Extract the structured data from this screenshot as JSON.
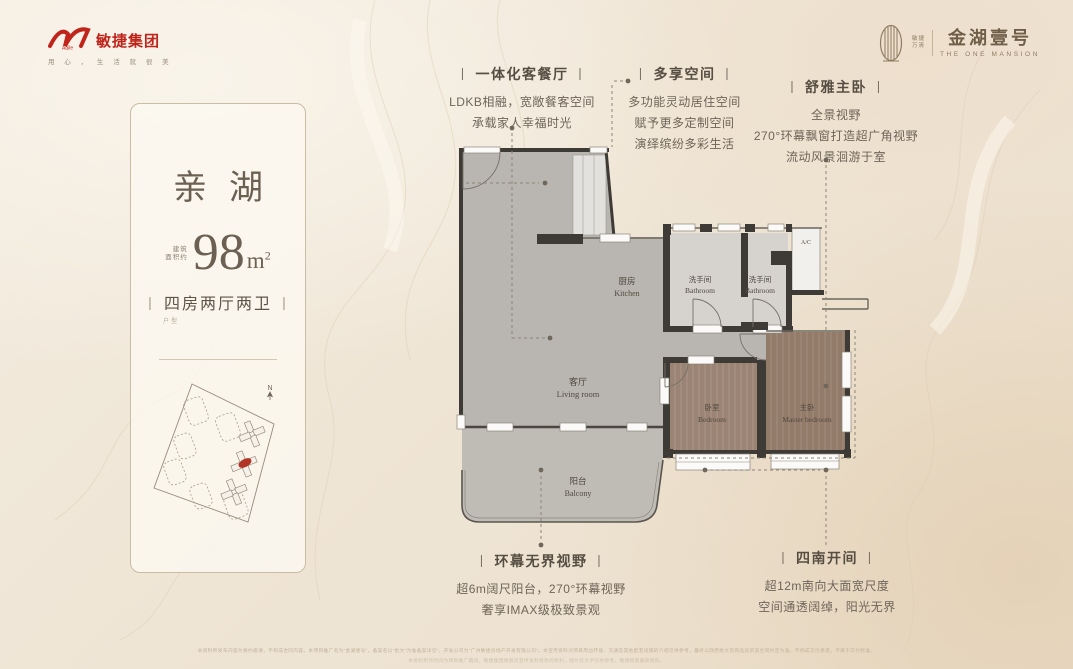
{
  "ui": {
    "bar": "丨"
  },
  "brand_left": {
    "logo_text": "敏捷集团",
    "logo_sub": "Agile",
    "tagline": "用 心 ， 生 活 就 很 美"
  },
  "brand_right": {
    "stack_top": "敏捷",
    "stack_bottom": "万清",
    "name": "金湖壹号",
    "name_en": "THE ONE MANSION"
  },
  "card": {
    "title": "亲湖",
    "area_label_1": "建筑",
    "area_label_2": "面积约",
    "area_value": "98",
    "area_unit": "m",
    "area_sup": "2",
    "layout": "四房两厅两卫",
    "note": "户型",
    "north": "N"
  },
  "annotations": [
    {
      "heading": "一体化客餐厅",
      "lines": [
        "LDKB相融，宽敞餐客空间",
        "承载家人幸福时光"
      ]
    },
    {
      "heading": "多享空间",
      "lines": [
        "多功能灵动居住空间",
        "赋予更多定制空间",
        "演绎缤纷多彩生活"
      ]
    },
    {
      "heading": "舒雅主卧",
      "lines": [
        "全景视野",
        "270°环幕飘窗打造超广角视野",
        "流动风景洄游于室"
      ]
    },
    {
      "heading": "环幕无界视野",
      "lines": [
        "超6m阔尺阳台，270°环幕视野",
        "奢享IMAX级极致景观"
      ]
    },
    {
      "heading": "四南开间",
      "lines": [
        "超12m南向大面宽尺度",
        "空间通透阔绰，阳光无界"
      ]
    }
  ],
  "plan": {
    "kitchen_zh": "厨房",
    "kitchen_en": "Kitchen",
    "bath_zh": "洗手间",
    "bath_en": "Bathroom",
    "living_zh": "客厅",
    "living_en": "Living room",
    "balcony_zh": "阳台",
    "balcony_en": "Balcony",
    "bedroom_zh": "卧室",
    "bedroom_en": "Bedroom",
    "master_zh": "主卧",
    "master_en": "Master bedroom",
    "ac": "A/C"
  },
  "footer": {
    "line1": "本资料所发布内容为要约邀请，不构成合同内容。本项目推广名为“金湖壹号”，备案名以“批文”为准备案详见“，开发公司为“广州敏捷房地产开发有限公司”。本宣传资料对项目周边环境、交通及其他配套设施的介绍仅供参考，最终以政府批文及商品房买卖合同约定为准，不构成交付承诺，不属于交付标准。",
    "line2": "本资料制作时间为项目推广期间，敏捷集团保留对宣传资料修改的权利，图片及文字仅供参考，敬请留意最新资料。"
  },
  "colors": {
    "brand_red": "#c0251c",
    "gold": "#8d7c62",
    "wall": "#3e3b36",
    "floor_gray": "#b9b6b1",
    "floor_brown": "#9a8373",
    "bg": "#efe5d6",
    "text_brown": "#6b6052"
  }
}
